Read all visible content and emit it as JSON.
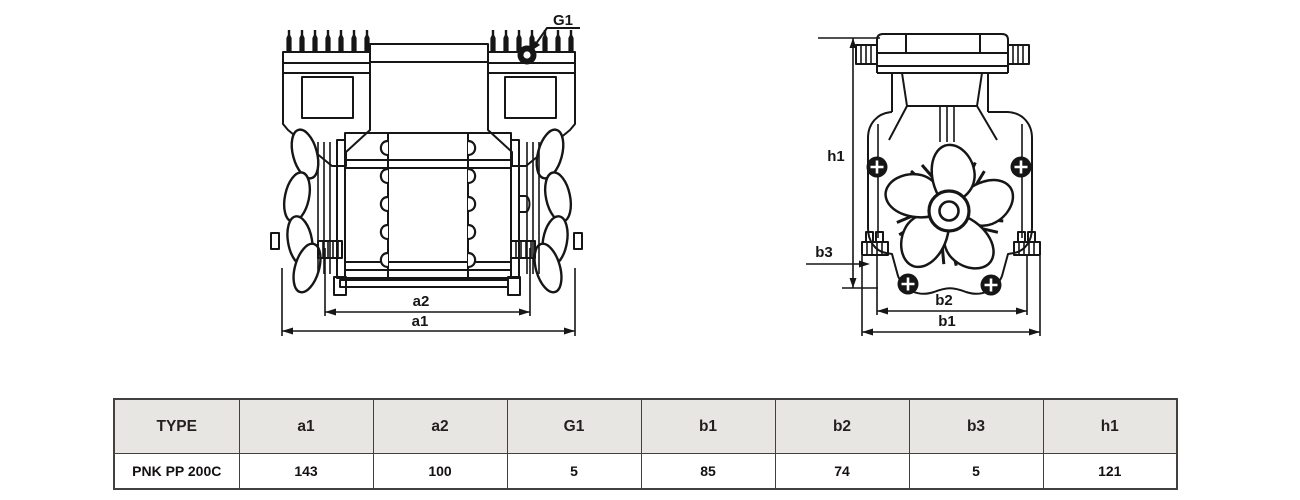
{
  "drawing": {
    "labels": {
      "g1": "G1",
      "a1": "a1",
      "a2": "a2",
      "h1": "h1",
      "b1": "b1",
      "b2": "b2",
      "b3": "b3"
    }
  },
  "table": {
    "columns": [
      "TYPE",
      "a1",
      "a2",
      "G1",
      "b1",
      "b2",
      "b3",
      "h1"
    ],
    "rows": [
      {
        "type": "PNK PP 200C",
        "values": [
          "143",
          "100",
          "5",
          "85",
          "74",
          "5",
          "121"
        ]
      }
    ]
  },
  "colors": {
    "line": "#161616",
    "table_header_bg": "#e8e6e3",
    "table_border": "#454040"
  }
}
